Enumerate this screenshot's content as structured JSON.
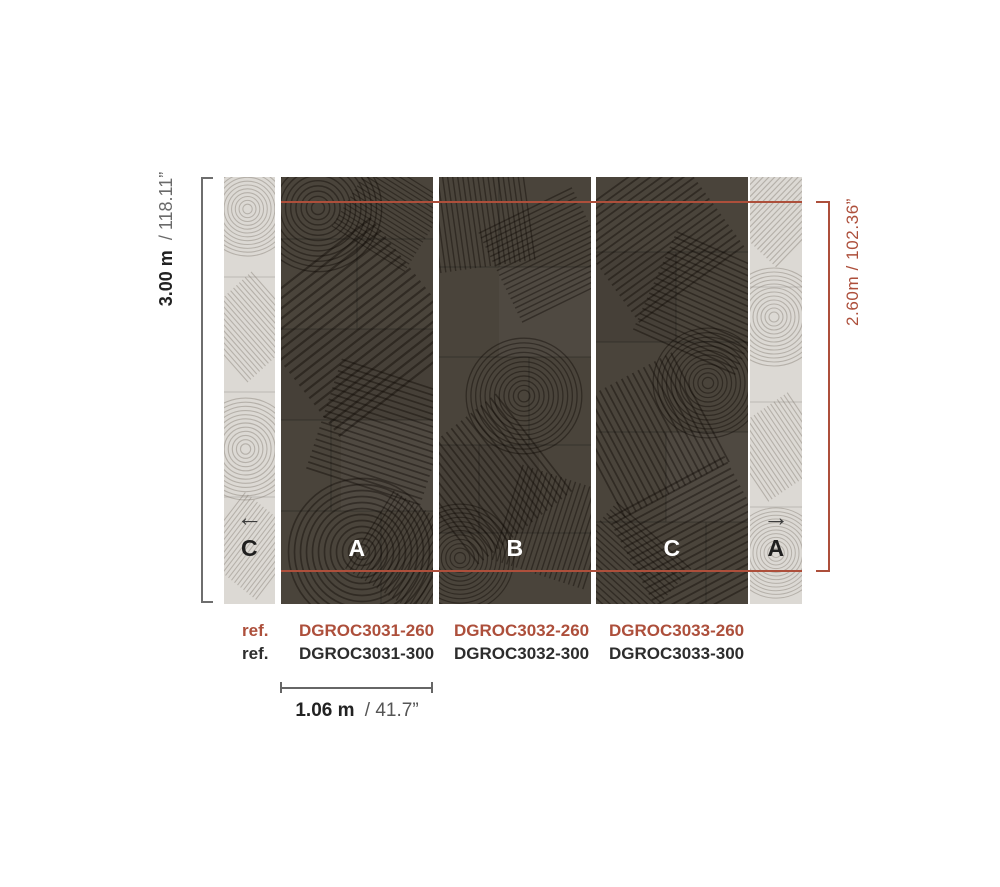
{
  "colors": {
    "accent_red": "#ad4f3b",
    "panel_dark": "#4a443b",
    "panel_light": "#dcd9d4",
    "text_dark": "#222222",
    "text_gray": "#6a6a6a"
  },
  "dimension_height_full": {
    "bold": "3.00 m",
    "rest": "/ 118.11”"
  },
  "dimension_height_print": {
    "text": "2.60m / 102.36”"
  },
  "dimension_width_panel": {
    "bold": "1.06 m",
    "rest": "/ 41.7”"
  },
  "panels": {
    "left_partial": {
      "letter": "C",
      "arrow": "←"
    },
    "dark_letters": [
      "A",
      "B",
      "C"
    ],
    "right_partial": {
      "letter": "A",
      "arrow": "→"
    }
  },
  "refs": {
    "row_260": {
      "label": "ref.",
      "codes": [
        "DGROC3031-260",
        "DGROC3032-260",
        "DGROC3033-260"
      ]
    },
    "row_300": {
      "label": "ref.",
      "codes": [
        "DGROC3031-300",
        "DGROC3032-300",
        "DGROC3033-300"
      ]
    }
  }
}
